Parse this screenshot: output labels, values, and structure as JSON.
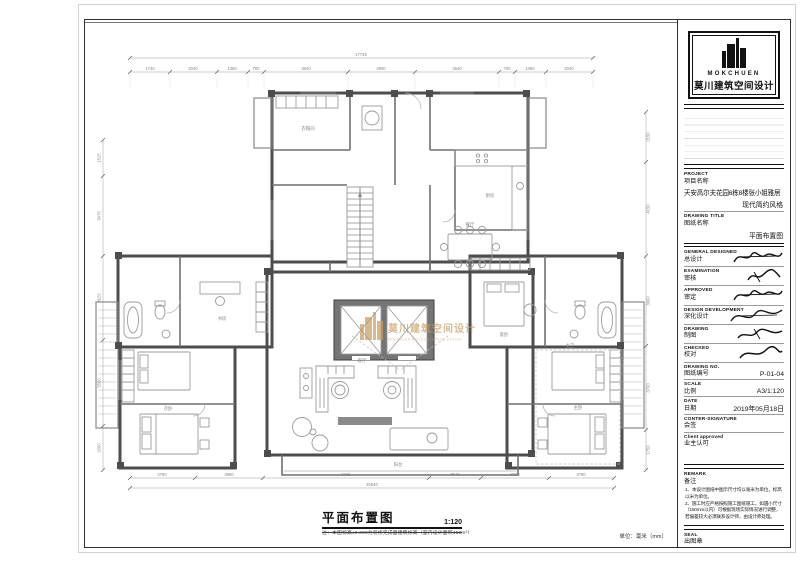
{
  "brand": {
    "logo_en": "MOKCHUEN",
    "logo_cn": "莫川建筑空间设计"
  },
  "watermark": {
    "cn": "莫川建筑空间设计",
    "en": "MOKCHUEN BUILDING SPACE DESIGN",
    "color": "#c79b60"
  },
  "titleblock": {
    "project": {
      "en": "PROJECT",
      "cn": "项目名称",
      "value1": "天安高尔夫花园6栋8楼张小姐雅居",
      "value2": "现代简约风格"
    },
    "drawing_title": {
      "en": "DRAWING TITLE",
      "cn": "图纸名称",
      "value": "平面布置图"
    },
    "general_designed": {
      "en": "GENERAL  DESIGNED",
      "cn": "总设计"
    },
    "examination": {
      "en": "EXAMINATION",
      "cn": "审核"
    },
    "approved": {
      "en": "APPROVED",
      "cn": "审定"
    },
    "design_development": {
      "en": "DESIGN DEVELOPMENT",
      "cn": "深化设计"
    },
    "drawing": {
      "en": "DRAWING",
      "cn": "制图"
    },
    "checked": {
      "en": "CHECKED",
      "cn": "校对"
    },
    "drawing_no": {
      "en": "DRAWING NO.",
      "cn": "图纸编号",
      "value": "P-01-04"
    },
    "scale": {
      "en": "SCALE",
      "cn": "比例",
      "value": "A3/1:120"
    },
    "date": {
      "en": "DATE",
      "cn": "日期",
      "value": "2019年05月18日"
    },
    "counter_signature": {
      "en": "CONTER-SIGNATURE",
      "cn": "会签"
    },
    "client_approved": {
      "en": "Client approved",
      "cn": "业主认可"
    },
    "remark": {
      "en": "REMARK",
      "cn": "备注",
      "note1": "1、本设计图纸中图示尺寸均以毫米为单位，标高以米为单位。",
      "note2": "2、施工时应严格按照施工图纸施工，如遇小尺寸（150mm以内）可根据现场实际情况进行调整，若偏差较大必须联系设计师，由设计师处理。"
    },
    "seal": {
      "en": "SEAL",
      "cn": "出图章"
    }
  },
  "footer": {
    "title": "平面布置图",
    "scale": "1:120",
    "note": "注：本图标高±0.000为装修完成面建筑标高（室内设计面积458m²）",
    "units": "单位：毫米（mm）"
  },
  "plan": {
    "labels": {
      "living": "客厅",
      "dining": "餐厅",
      "kitchen": "厨房",
      "balcony": "阳台",
      "master": "主卧",
      "bedroom2": "次卧",
      "study": "书房",
      "guest": "客卧",
      "bath": "主卫",
      "cloak": "衣帽间"
    },
    "total_top": "17725",
    "total_bottom": "30540",
    "dims_top": [
      "1740",
      "2040",
      "1360",
      "700",
      "3640",
      "2900",
      "3640",
      "700",
      "1360",
      "2040"
    ],
    "dims_bottom": [
      "3780",
      "3960",
      "9635",
      "3045",
      "3960",
      "3780"
    ],
    "dims_left": [
      "1525",
      "3475",
      "3625",
      "5550",
      "2000"
    ],
    "dims_right": [
      "2150",
      "4150",
      "3900",
      "3700",
      "1750"
    ]
  }
}
